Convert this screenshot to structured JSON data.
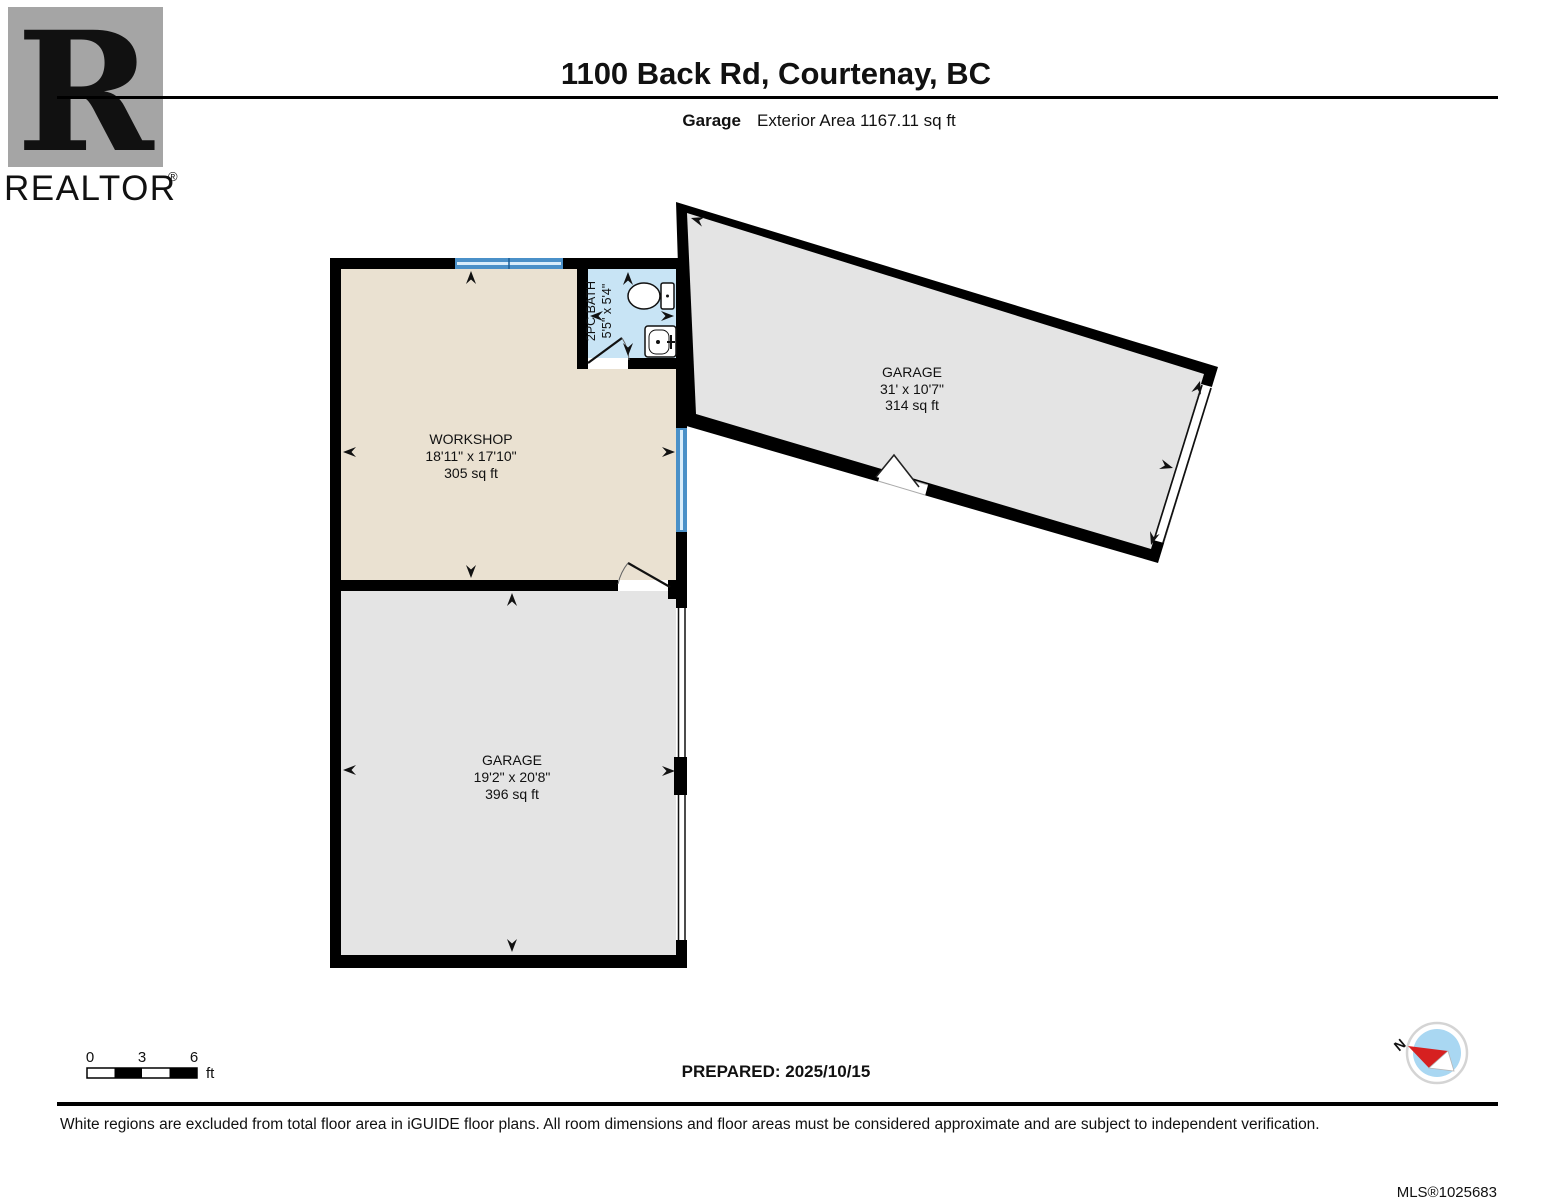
{
  "header": {
    "title": "1100 Back Rd, Courtenay, BC",
    "floor_name": "Garage",
    "floor_area": "Exterior Area 1167.11 sq ft"
  },
  "logo": {
    "letter": "R",
    "brand": "REALTOR",
    "registered": "®"
  },
  "rooms": {
    "workshop": {
      "name": "WORKSHOP",
      "dims": "18'11\" x 17'10\"",
      "area": "305 sq ft"
    },
    "bath": {
      "name": "2PC BATH",
      "dims": "5'5\" x 5'4\""
    },
    "garage_upper": {
      "name": "GARAGE",
      "dims": "31' x 10'7\"",
      "area": "314 sq ft"
    },
    "garage_lower": {
      "name": "GARAGE",
      "dims": "19'2\" x 20'8\"",
      "area": "396 sq ft"
    }
  },
  "scale_bar": {
    "t0": "0",
    "t1": "3",
    "t2": "6",
    "unit": "ft"
  },
  "prepared_label": "PREPARED: 2025/10/15",
  "compass": {
    "north": "N"
  },
  "footer": {
    "disclaimer": "White regions are excluded from total floor area in iGUIDE floor plans. All room dimensions and floor areas must be considered approximate and are subject to independent verification.",
    "mls": "MLS®1025683"
  },
  "colors": {
    "wall_black": "#000000",
    "workshop_fill": "#eae1d1",
    "garage_fill": "#e4e4e4",
    "bath_fill": "#c8e4f5",
    "window_blue": "#4a90c8",
    "window_light": "#d9edfb",
    "logo_gray": "#a5a5a5",
    "compass_blue": "#a9d7f2",
    "needle_red": "#d62020",
    "mls_gray": "#b4b4b4"
  }
}
